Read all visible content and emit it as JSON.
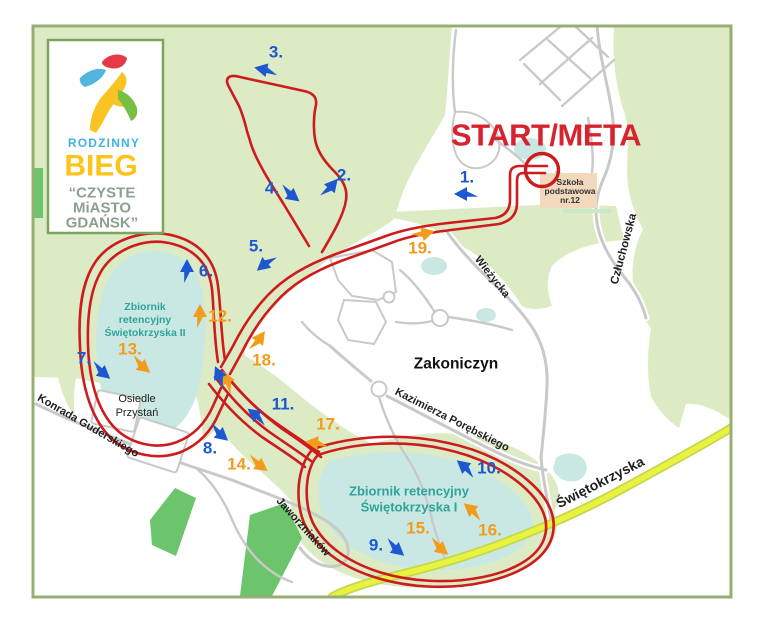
{
  "logo": {
    "line1": "RODZINNY",
    "line2": "BIEG",
    "line3": "“CZYSTE",
    "line4": "MiASTO",
    "line5": "GDAŃSK”"
  },
  "start_meta": "START/META",
  "school": {
    "lines": [
      "Szkoła",
      "podstawowa",
      "nr.12"
    ]
  },
  "lakes": {
    "res2": [
      "Zbiornik",
      "retencyjny",
      "Świętokrzyska II"
    ],
    "res1": [
      "Zbiornik retencyjny",
      "Świętokrzyska I"
    ]
  },
  "areas": {
    "zakoniczyn": "Zakoniczyn",
    "osiedle_line1": "Osiedle",
    "osiedle_line2": "Przystań"
  },
  "streets": {
    "czluchowska": "Człuchowska",
    "wiezycka": "Wieżycka",
    "kazimierza": "Kazimierza Porębskiego",
    "konrada": "Konrada Guderskiego",
    "jaworzniakow": "Jaworzniaków",
    "swietokrzyska": "Świętokrzyska"
  },
  "markers": [
    {
      "label": "1.",
      "color": "blue"
    },
    {
      "label": "2.",
      "color": "blue"
    },
    {
      "label": "3.",
      "color": "blue"
    },
    {
      "label": "4.",
      "color": "blue"
    },
    {
      "label": "5.",
      "color": "blue"
    },
    {
      "label": "6.",
      "color": "blue"
    },
    {
      "label": "7.",
      "color": "blue"
    },
    {
      "label": "8.",
      "color": "blue"
    },
    {
      "label": "9.",
      "color": "blue"
    },
    {
      "label": "10.",
      "color": "blue"
    },
    {
      "label": "11.",
      "color": "blue"
    },
    {
      "label": "12.",
      "color": "orange"
    },
    {
      "label": "13.",
      "color": "orange"
    },
    {
      "label": "14.",
      "color": "orange"
    },
    {
      "label": "15.",
      "color": "orange"
    },
    {
      "label": "16.",
      "color": "orange"
    },
    {
      "label": "17.",
      "color": "orange"
    },
    {
      "label": "18.",
      "color": "orange"
    },
    {
      "label": "19.",
      "color": "orange"
    }
  ],
  "colors": {
    "route_red": "#ce1b1d",
    "marker_blue": "#1d58d0",
    "marker_orange": "#f39b1b",
    "water": "#c9e8e3",
    "water_text": "#2fa39b",
    "green_light": "#dcebc4",
    "green_mid": "#6cc46c",
    "road_gray": "#c9c9c9",
    "yellow_road": "#e9f23f",
    "start_red": "#d7232e",
    "frame_green": "#96af70",
    "school_fill": "#f2d8bc"
  }
}
